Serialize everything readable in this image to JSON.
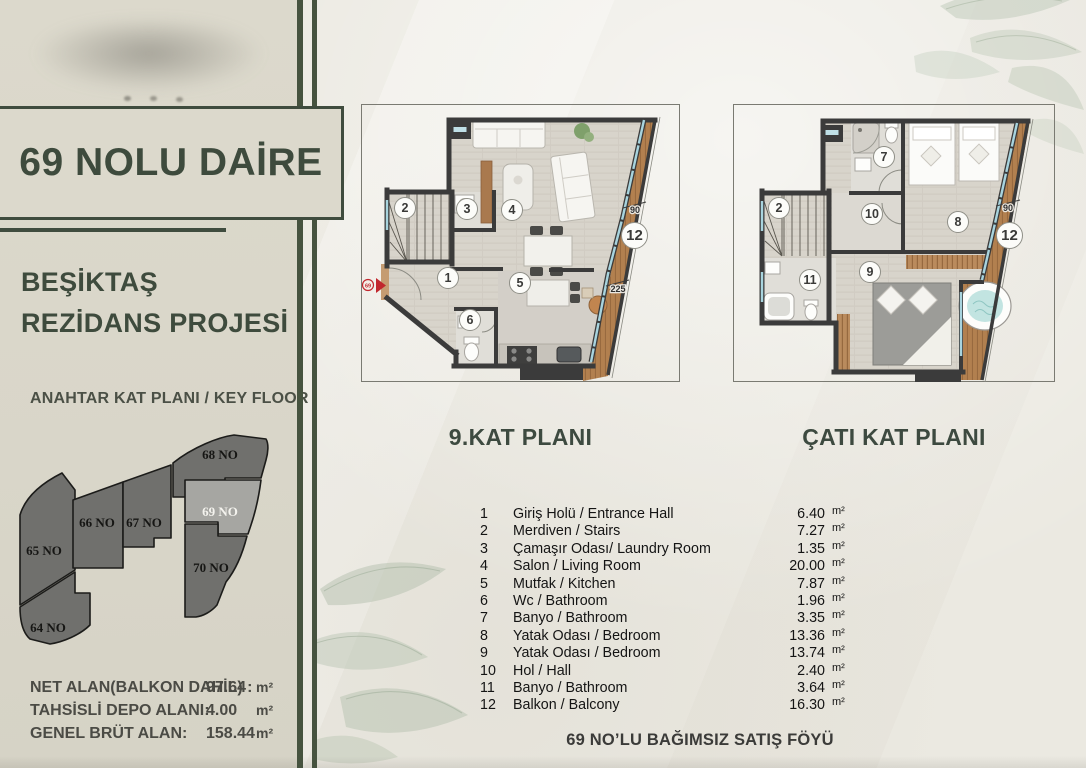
{
  "sidebar": {
    "apartment_title": "69 NOLU DAİRE",
    "project_name_line1": "BEŞİKTAŞ",
    "project_name_line2": "REZİDANS PROJESİ",
    "keyplan_heading": "ANAHTAR KAT PLANI / KEY FLOOR",
    "keyplan_units": [
      {
        "label": "68 NO",
        "highlighted": false
      },
      {
        "label": "69 NO",
        "highlighted": true
      },
      {
        "label": "67 NO",
        "highlighted": false
      },
      {
        "label": "66 NO",
        "highlighted": false
      },
      {
        "label": "65 NO",
        "highlighted": false
      },
      {
        "label": "70 NO",
        "highlighted": false
      },
      {
        "label": "64 NO",
        "highlighted": false
      }
    ],
    "area_summary": [
      {
        "label": "NET ALAN(BALKON DAHİL) :",
        "value": "97.64",
        "unit": "m²"
      },
      {
        "label": "TAHSİSLİ DEPO ALANI:",
        "value": "4.00",
        "unit": "m²"
      },
      {
        "label": "GENEL BRÜT ALAN:",
        "value": "158.44",
        "unit": "m²"
      }
    ]
  },
  "plans": {
    "left_title": "9.KAT PLANI",
    "right_title": "ÇATI KAT PLANI",
    "entry_marker": "69",
    "left_badges": [
      "2",
      "3",
      "4",
      "1",
      "5",
      "6",
      "12"
    ],
    "right_badges": [
      "2",
      "7",
      "10",
      "8",
      "9",
      "11",
      "12"
    ],
    "dims": {
      "left_90": "90",
      "left_225": "225",
      "right_90": "90"
    }
  },
  "room_list": [
    {
      "no": "1",
      "name": "Giriş Holü / Entrance Hall",
      "area": "6.40",
      "unit": "m²"
    },
    {
      "no": "2",
      "name": "Merdiven / Stairs",
      "area": "7.27",
      "unit": "m²"
    },
    {
      "no": "3",
      "name": "Çamaşır Odası/ Laundry Room",
      "area": "1.35",
      "unit": "m²"
    },
    {
      "no": "4",
      "name": "Salon / Living Room",
      "area": "20.00",
      "unit": "m²"
    },
    {
      "no": "5",
      "name": "Mutfak / Kitchen",
      "area": "7.87",
      "unit": "m²"
    },
    {
      "no": "6",
      "name": "Wc / Bathroom",
      "area": "1.96",
      "unit": "m²"
    },
    {
      "no": "7",
      "name": "Banyo / Bathroom",
      "area": "3.35",
      "unit": "m²"
    },
    {
      "no": "8",
      "name": "Yatak Odası / Bedroom",
      "area": "13.36",
      "unit": "m²"
    },
    {
      "no": "9",
      "name": "Yatak Odası / Bedroom",
      "area": "13.74",
      "unit": "m²"
    },
    {
      "no": "10",
      "name": "Hol / Hall",
      "area": "2.40",
      "unit": "m²"
    },
    {
      "no": "11",
      "name": "Banyo / Bathroom",
      "area": "3.64",
      "unit": "m²"
    },
    {
      "no": "12",
      "name": "Balkon / Balcony",
      "area": "16.30",
      "unit": "m²"
    }
  ],
  "footer": "69 NO’LU BAĞIMSIZ SATIŞ FÖYÜ",
  "colors": {
    "accent_green": "#3f4c3e",
    "sidebar_beige": "#dad7ca",
    "wall_dark": "#3b3b3b",
    "balcony_wood": "#b2804f",
    "window_glass": "#a8d4de",
    "keyplan_unit": "#70706d",
    "keyplan_highlight": "#a6a6a2",
    "entry_red": "#c1272d"
  }
}
